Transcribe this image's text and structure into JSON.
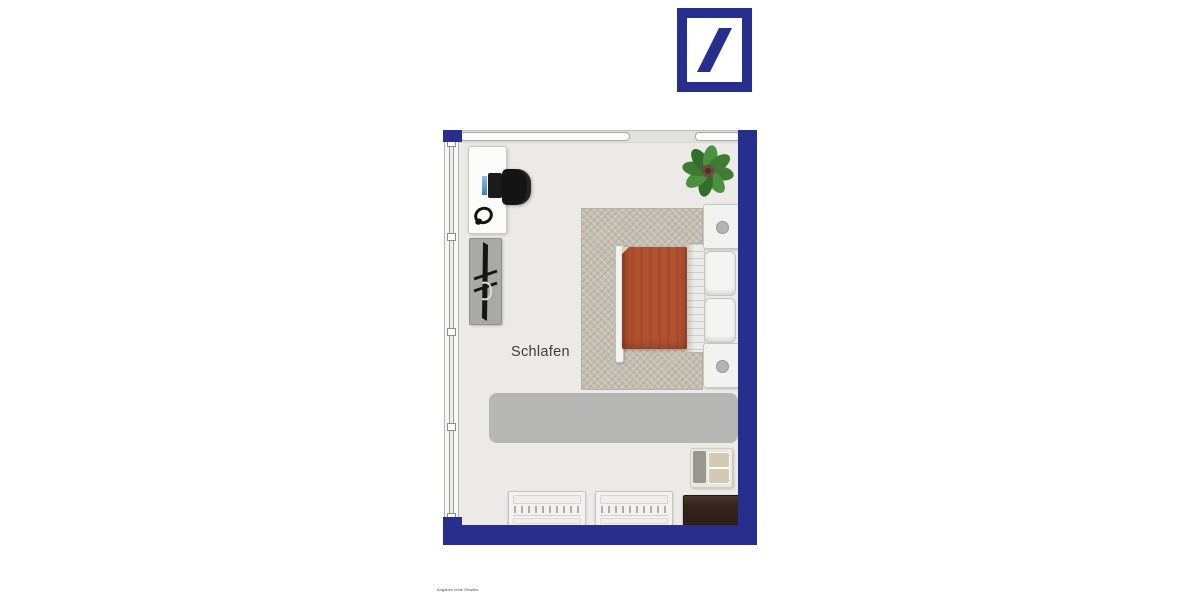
{
  "theme": {
    "wall_blue": "#262f8d",
    "floor": "#ebeae7",
    "carpet_beige": "#c4beb2",
    "blanket_terracotta": "#b05130",
    "rug_gray": "#b6b6b4",
    "plant_green": "#3e7c33",
    "furniture_white": "#f3f2f0",
    "dark_wood": "#33231b"
  },
  "brand": {
    "logo_icon": "slash-in-square-logo"
  },
  "floorplan": {
    "room_label": "Schlafen",
    "furniture": [
      "desk",
      "computer-monitor",
      "office-chair",
      "headphones",
      "drying-rack-on-mat",
      "potted-plant",
      "herringbone-carpet",
      "double-bed",
      "orange-blanket",
      "white-duvet",
      "pillows",
      "nightstand-top",
      "nightstand-bottom",
      "gray-rug",
      "armchair",
      "chest-of-drawers-left",
      "chest-of-drawers-right",
      "dark-sideboard"
    ],
    "windows": [
      "left-wall-window",
      "top-wall-window-long",
      "top-wall-window-short"
    ]
  },
  "footer": {
    "disclaimer": "Angaben ohne Gewähr"
  }
}
